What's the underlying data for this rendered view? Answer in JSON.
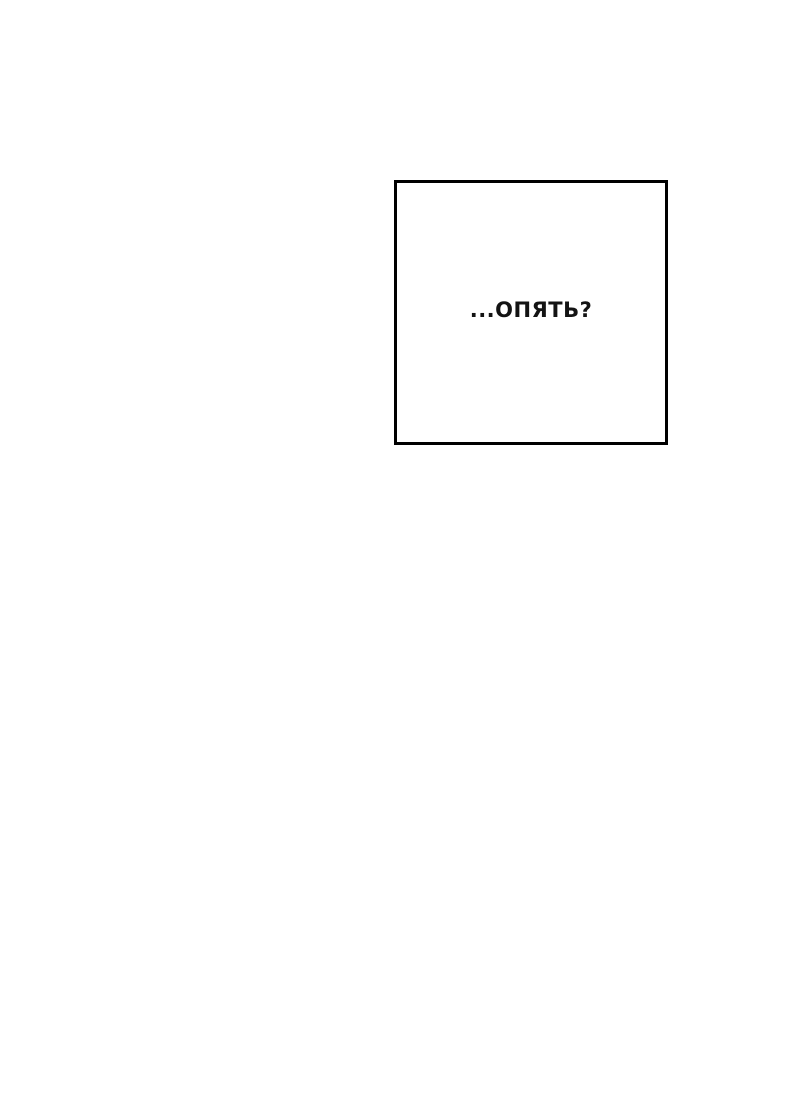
{
  "page": {
    "type": "comic-page",
    "background_color": "#ffffff"
  },
  "panel": {
    "border_color": "#000000",
    "background_color": "#ffffff",
    "caption": {
      "text": "...ОПЯТЬ?",
      "color": "#131313"
    }
  }
}
